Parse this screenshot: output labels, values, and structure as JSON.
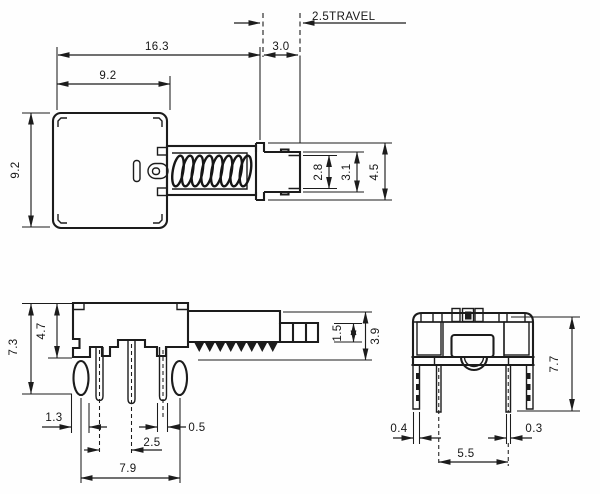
{
  "drawing": {
    "type": "technical-dimension-drawing",
    "subject": "push-button switch, three orthographic views",
    "colors": {
      "ink": "#1c1c1c",
      "background": "#fefefe"
    }
  },
  "top_view": {
    "travel_label": "2.5TRAVEL",
    "dim_gap": "3.0",
    "dim_overall_length": "16.3",
    "dim_body_width": "9.2",
    "dim_body_height": "9.2",
    "dim_plunger_tip": "2.8",
    "dim_plunger_mid": "3.1",
    "dim_plunger_flange": "4.5"
  },
  "side_view": {
    "dim_overall_height": "7.3",
    "dim_body_height": "4.7",
    "dim_post_width": "1.3",
    "dim_pin_pitch": "2.5",
    "dim_pin_width": "0.5",
    "dim_post_pitch": "7.9",
    "dim_segment_height": "1.5",
    "dim_shaft_height": "3.9"
  },
  "front_view": {
    "dim_overall_height": "7.7",
    "dim_leg_width": "0.4",
    "dim_pin_width": "0.3",
    "dim_pin_spacing": "5.5"
  }
}
